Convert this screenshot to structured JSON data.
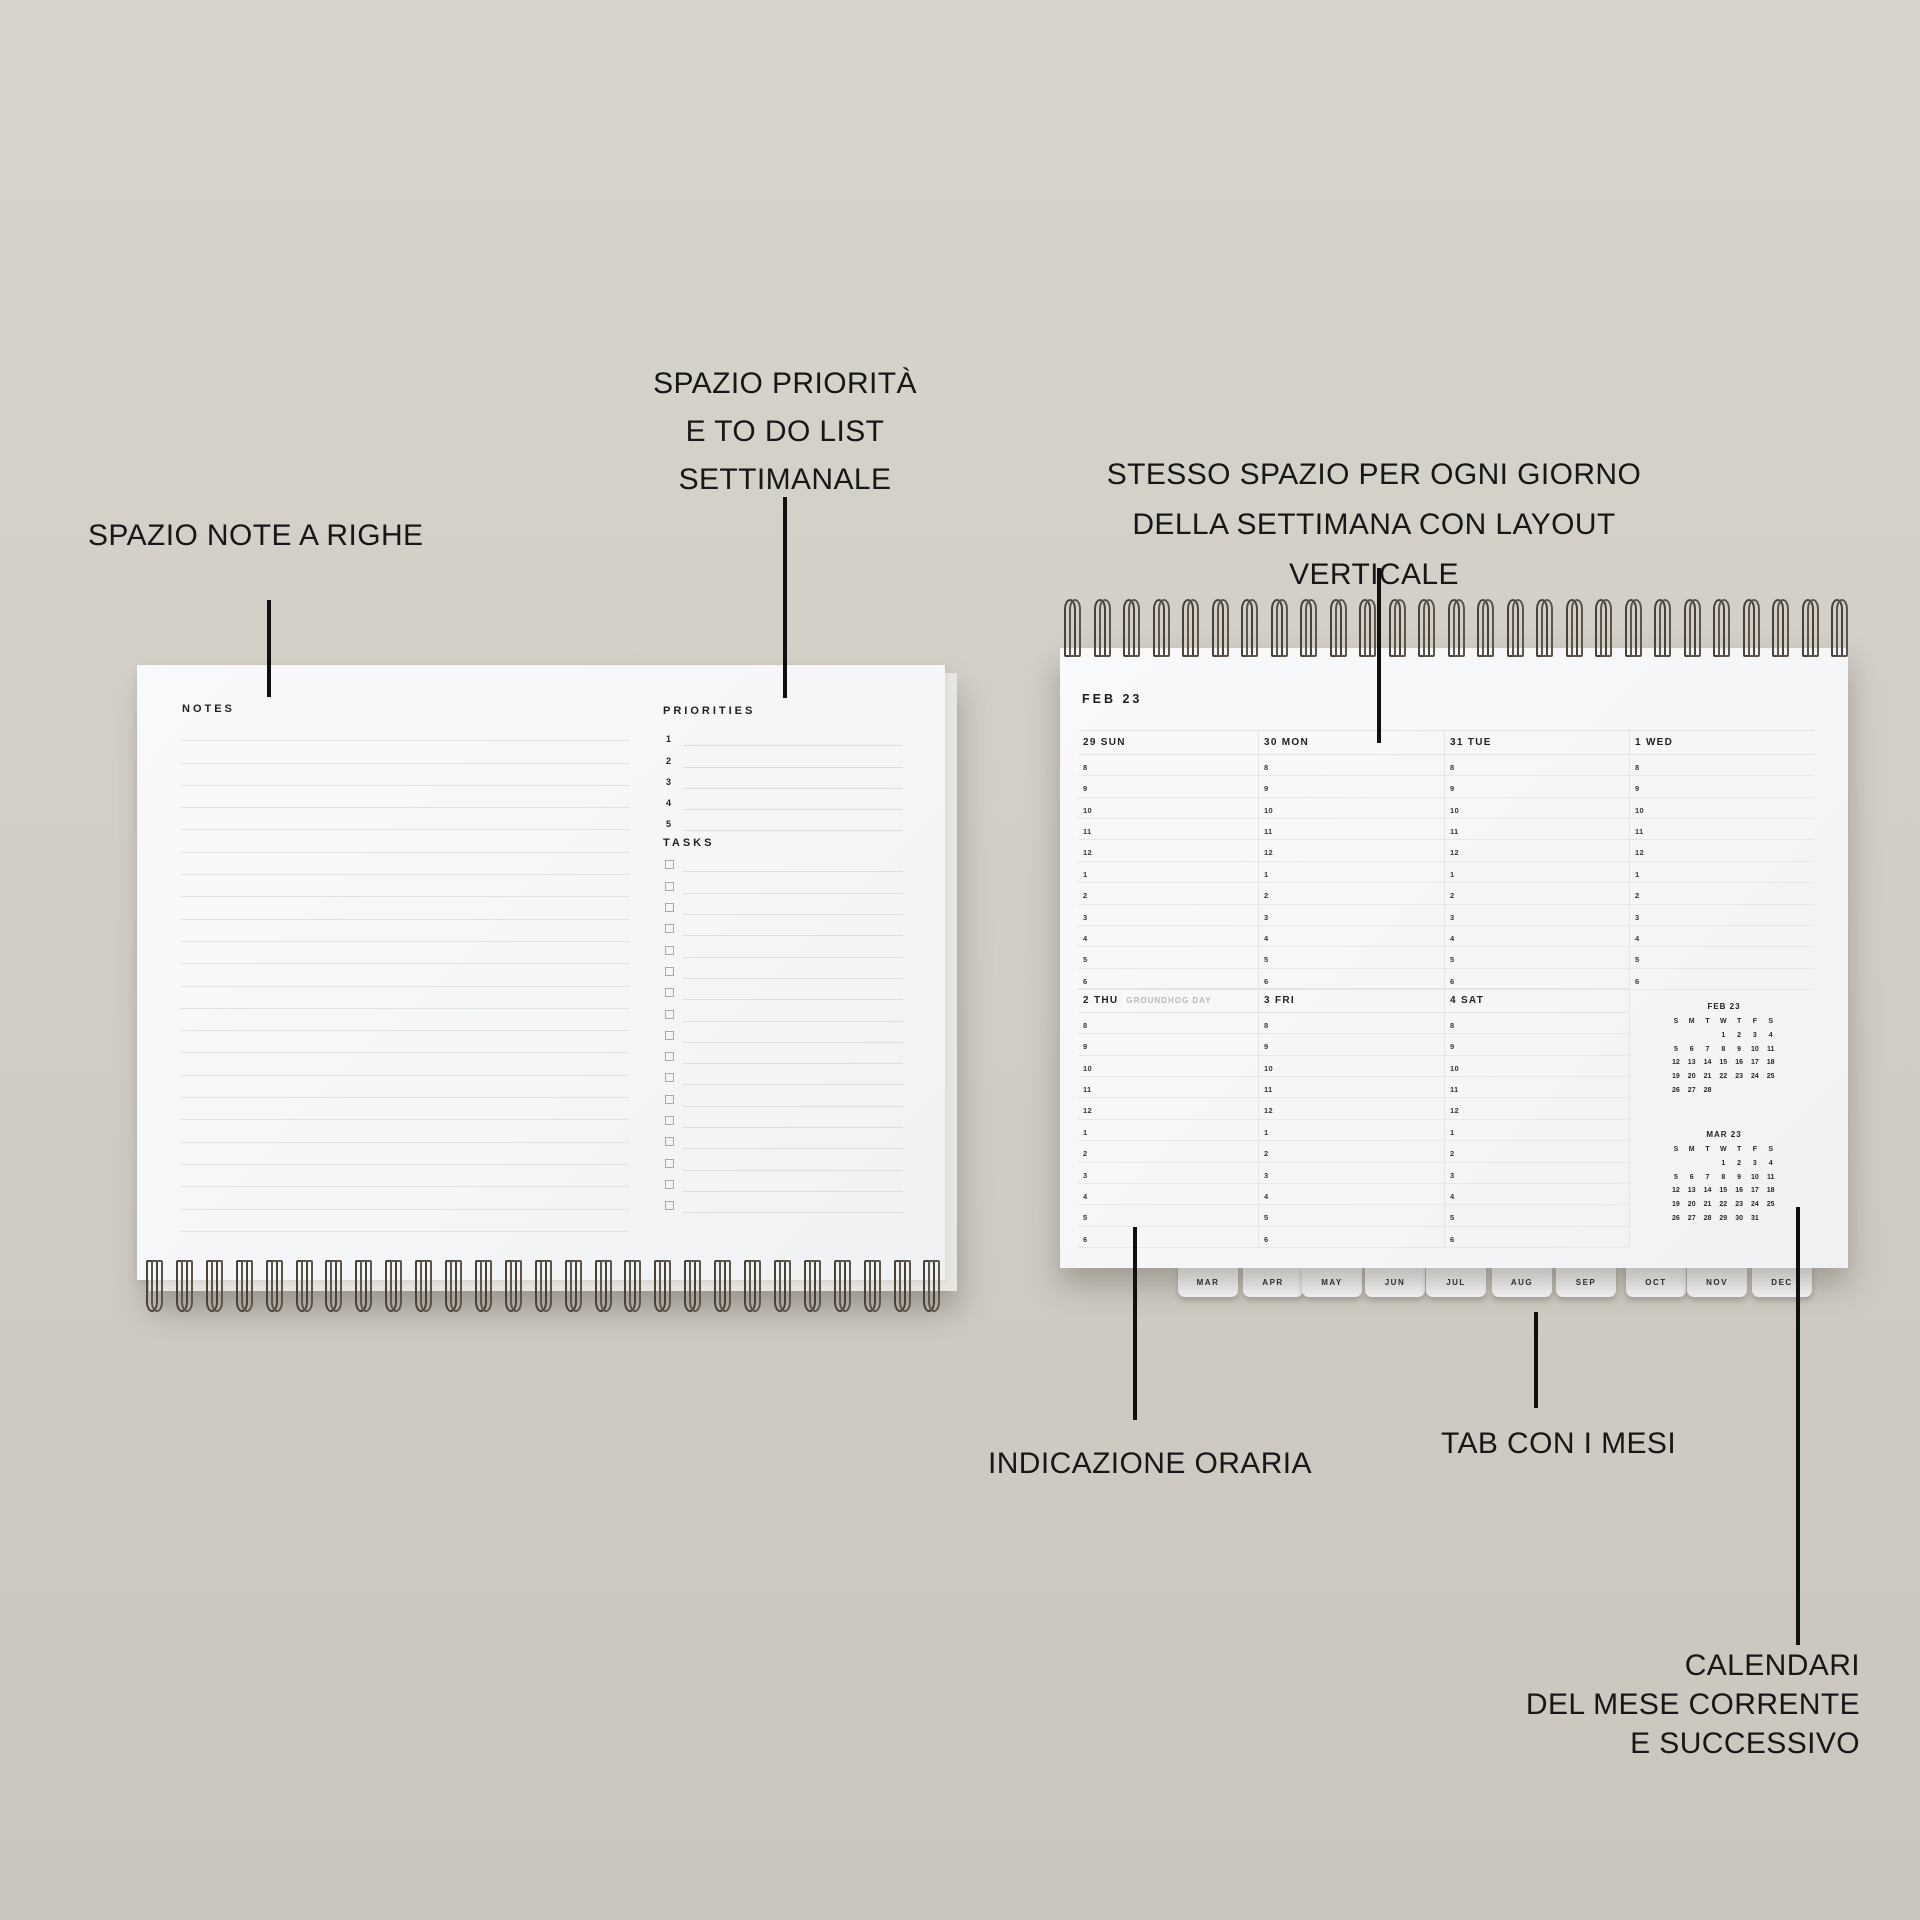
{
  "colors": {
    "background": "#d3cfc7",
    "paper": "#f6f7f9",
    "wire": "#48423a",
    "annotation": "#171717",
    "muted": "#b5b9be"
  },
  "annotations": {
    "notes": {
      "text": "SPAZIO NOTE A RIGHE"
    },
    "priorities": {
      "lines": [
        "SPAZIO PRIORITÀ",
        "E TO DO LIST",
        "SETTIMANALE"
      ]
    },
    "same_space": {
      "lines": [
        "STESSO SPAZIO PER OGNI GIORNO",
        "DELLA SETTIMANA CON LAYOUT VERTICALE"
      ]
    },
    "hours": {
      "text": "INDICAZIONE ORARIA"
    },
    "tabs": {
      "text": "TAB CON I MESI"
    },
    "calendars": {
      "lines": [
        "CALENDARI",
        "DEL MESE CORRENTE",
        "E SUCCESSIVO"
      ]
    }
  },
  "notes_page": {
    "notes_label": "NOTES",
    "priorities_label": "PRIORITIES",
    "priority_numbers": [
      "1",
      "2",
      "3",
      "4",
      "5"
    ],
    "tasks_label": "TASKS",
    "task_count": 17,
    "note_line_count": 23
  },
  "planner": {
    "title": "FEB 23",
    "week1": [
      {
        "label": "29 SUN"
      },
      {
        "label": "30 MON"
      },
      {
        "label": "31 TUE"
      },
      {
        "label": "1 WED"
      }
    ],
    "week2": [
      {
        "label": "2 THU",
        "note": "GROUNDHOG DAY"
      },
      {
        "label": "3 FRI"
      },
      {
        "label": "4 SAT"
      }
    ],
    "hours": [
      "8",
      "9",
      "10",
      "11",
      "12",
      "1",
      "2",
      "3",
      "4",
      "5",
      "6"
    ],
    "month_tabs": [
      "MAR",
      "APR",
      "MAY",
      "JUN",
      "JUL",
      "AUG",
      "SEP",
      "OCT",
      "NOV",
      "DEC"
    ],
    "mini_calendars": [
      {
        "title": "FEB 23",
        "dow": [
          "S",
          "M",
          "T",
          "W",
          "T",
          "F",
          "S"
        ],
        "weeks": [
          [
            "",
            "",
            "",
            "1",
            "2",
            "3",
            "4"
          ],
          [
            "5",
            "6",
            "7",
            "8",
            "9",
            "10",
            "11"
          ],
          [
            "12",
            "13",
            "14",
            "15",
            "16",
            "17",
            "18"
          ],
          [
            "19",
            "20",
            "21",
            "22",
            "23",
            "24",
            "25"
          ],
          [
            "26",
            "27",
            "28",
            "",
            "",
            "",
            ""
          ]
        ]
      },
      {
        "title": "MAR 23",
        "dow": [
          "S",
          "M",
          "T",
          "W",
          "T",
          "F",
          "S"
        ],
        "weeks": [
          [
            "",
            "",
            "",
            "1",
            "2",
            "3",
            "4"
          ],
          [
            "5",
            "6",
            "7",
            "8",
            "9",
            "10",
            "11"
          ],
          [
            "12",
            "13",
            "14",
            "15",
            "16",
            "17",
            "18"
          ],
          [
            "19",
            "20",
            "21",
            "22",
            "23",
            "24",
            "25"
          ],
          [
            "26",
            "27",
            "28",
            "29",
            "30",
            "31",
            ""
          ]
        ]
      }
    ]
  }
}
